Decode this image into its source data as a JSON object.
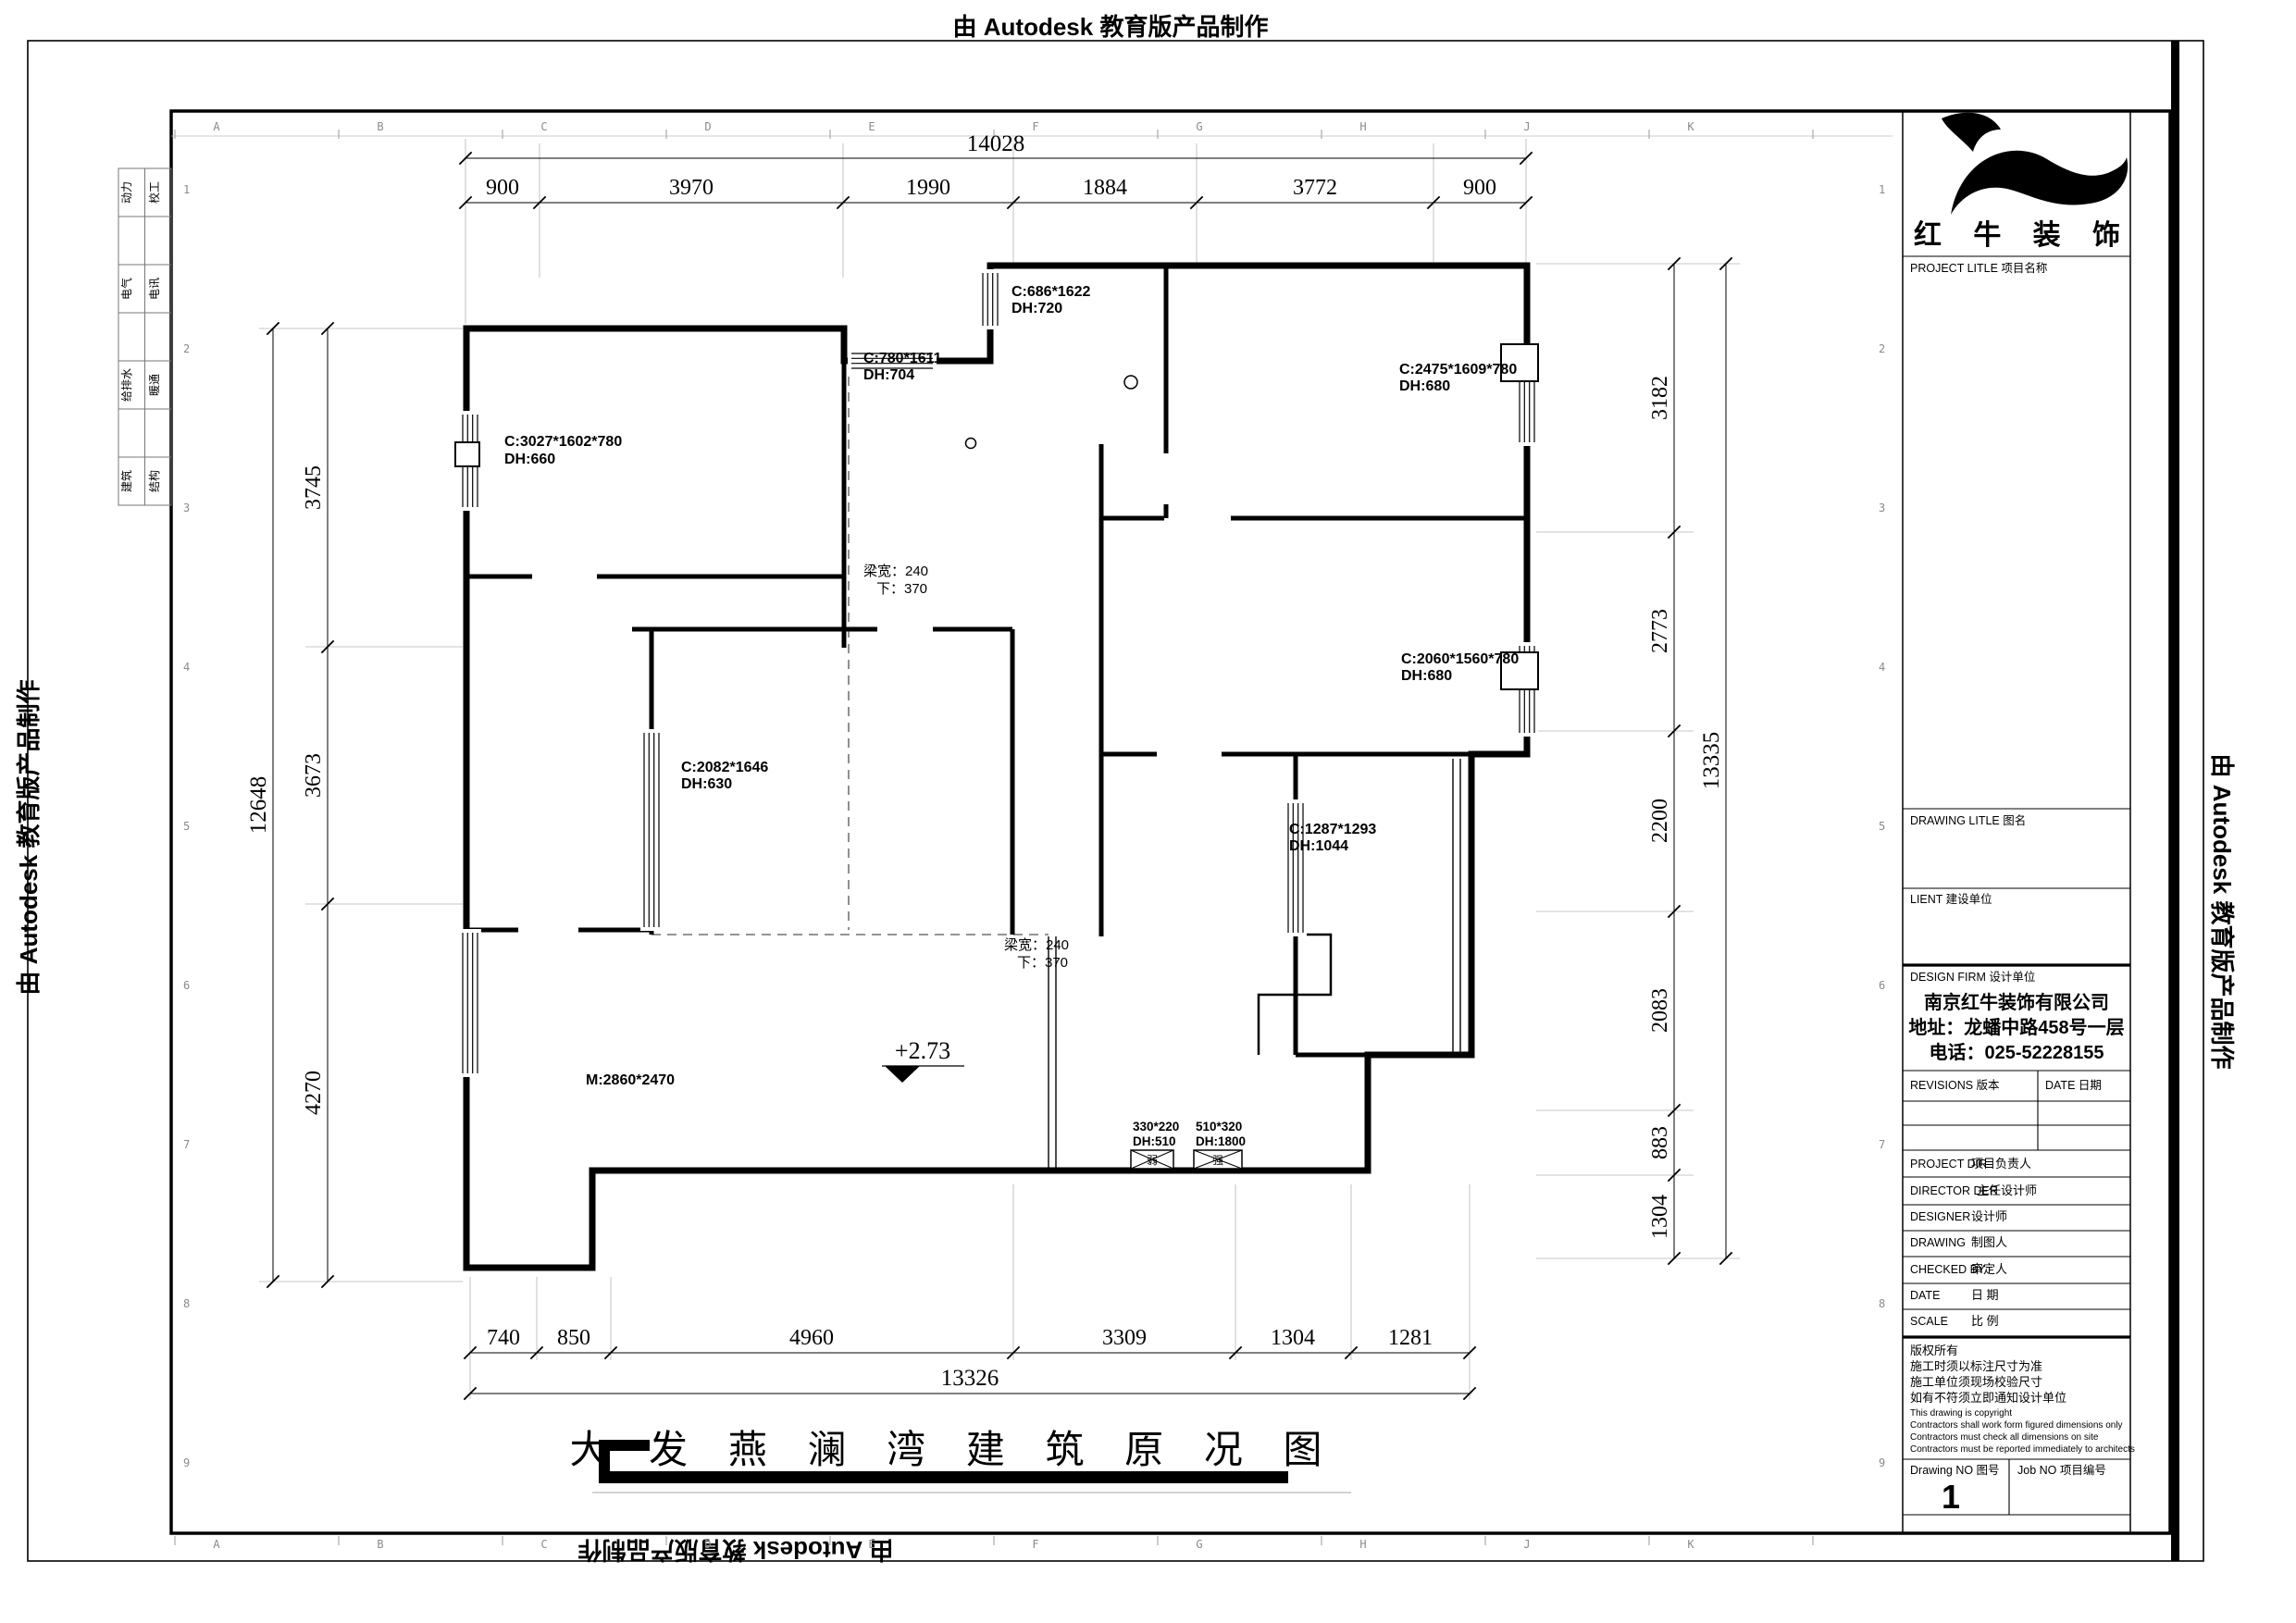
{
  "banner": {
    "text": "由 Autodesk 教育版产品制作"
  },
  "sheet": {
    "ruler_letters": [
      "A",
      "B",
      "C",
      "D",
      "E",
      "F",
      "G",
      "H",
      "J",
      "K"
    ],
    "ruler_numbers": [
      "1",
      "2",
      "3",
      "4",
      "5",
      "6",
      "7",
      "8",
      "9"
    ],
    "disciplines": [
      "动力",
      "校工",
      "电气",
      "电讯",
      "给排水",
      "暖通",
      "建筑",
      "结构"
    ]
  },
  "dims": {
    "top": {
      "total": "14028",
      "segs": [
        "900",
        "3970",
        "1990",
        "1884",
        "3772",
        "900"
      ]
    },
    "left": {
      "total": "12648",
      "segs": [
        "3745",
        "3673",
        "4270"
      ]
    },
    "right": {
      "total": "13335",
      "segs": [
        "3182",
        "2773",
        "2200",
        "2083",
        "883",
        "1304"
      ]
    },
    "bottom": {
      "total": "13326",
      "segs": [
        "740",
        "850",
        "4960",
        "3309",
        "1304",
        "1281"
      ]
    }
  },
  "plan": {
    "windows": {
      "w_left_top": {
        "l1": "C:3027*1602*780",
        "l2": "DH:660"
      },
      "w_mid_top": {
        "l1": "C:780*1611",
        "l2": "DH:704"
      },
      "w_top": {
        "l1": "C:686*1622",
        "l2": "DH:720"
      },
      "w_right_top": {
        "l1": "C:2475*1609*780",
        "l2": "DH:680"
      },
      "w_right_mid": {
        "l1": "C:2060*1560*780",
        "l2": "DH:680"
      },
      "w_mid": {
        "l1": "C:2082*1646",
        "l2": "DH:630"
      },
      "w_lower": {
        "l1": "C:1287*1293",
        "l2": "DH:1044"
      }
    },
    "beam1": {
      "l1": "梁宽：240",
      "l2": "下：370"
    },
    "beam2": {
      "l1": "梁宽：240",
      "l2": "下：370"
    },
    "door": "M:2860*2470",
    "level": "+2.73",
    "outlet_weak": {
      "l1": "330*220",
      "l2": "DH:510",
      "tag": "弱"
    },
    "outlet_strong": {
      "l1": "510*320",
      "l2": "DH:1800",
      "tag": "强"
    }
  },
  "title": "大 发 燕 澜 湾 建 筑 原 况 图",
  "tb": {
    "logo": "红 牛 装 饰",
    "project": "PROJECT LITLE  项目名称",
    "drawing": "DRAWING LITLE  图名",
    "client": "LIENT  建设单位",
    "firm": "DESIGN FIRM  设计单位",
    "company": [
      "南京红牛装饰有限公司",
      "地址：龙蟠中路458号一层",
      "电话：025-52228155"
    ],
    "revisions": "REVISIONS  版本",
    "date_col": "DATE  日期",
    "rows": [
      {
        "en": "PROJECT DIR",
        "cn": "项目负责人"
      },
      {
        "en": "DIRECTOR DER",
        "cn": "主任设计师"
      },
      {
        "en": "DESIGNER",
        "cn": "设计师"
      },
      {
        "en": "DRAWING",
        "cn": "制图人"
      },
      {
        "en": "CHECKED BY",
        "cn": "审定人"
      },
      {
        "en": "DATE",
        "cn": "日  期"
      },
      {
        "en": "SCALE",
        "cn": "比  例"
      }
    ],
    "copyright": [
      "版权所有",
      "施工时须以标注尺寸为准",
      "施工单位须现场校验尺寸",
      "如有不符须立即通知设计单位",
      "This drawing is copyright",
      "Contractors shall work form figured dimensions only",
      "Contractors must check all dimensions on site",
      "Contractors must be reported immediately to architects"
    ],
    "drawing_no_label": "Drawing NO  图号",
    "job_no_label": "Job NO  项目编号",
    "drawing_no": "1"
  }
}
